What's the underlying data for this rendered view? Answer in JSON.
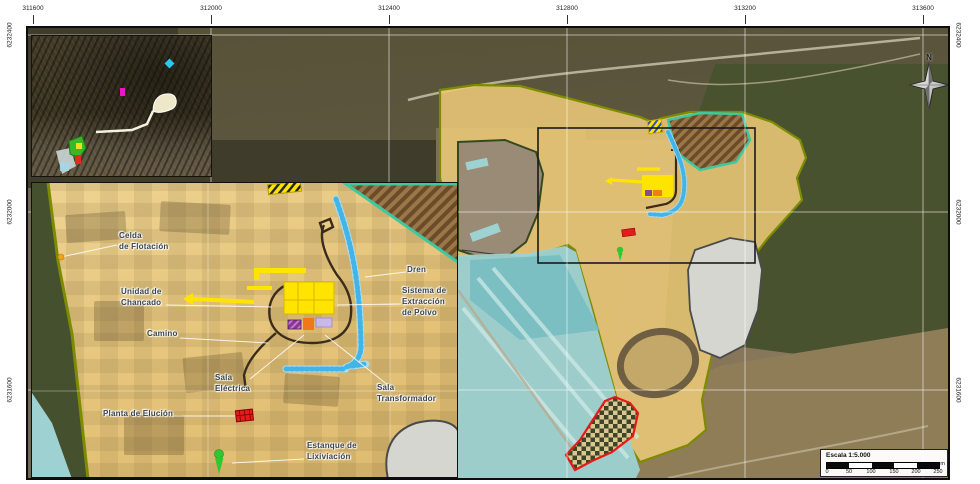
{
  "coordinates": {
    "top": [
      "311600",
      "312000",
      "312400",
      "312800",
      "313200",
      "313600"
    ],
    "left": [
      "6232400",
      "6232000",
      "6231600"
    ],
    "right": [
      "6232400",
      "6232000",
      "6231600"
    ]
  },
  "labels": {
    "celda": [
      "Celda",
      "de Flotación"
    ],
    "unidad": [
      "Unidad de",
      "Chancado"
    ],
    "camino": [
      "Camino"
    ],
    "sala_electrica": [
      "Sala",
      "Eléctrica"
    ],
    "planta": [
      "Planta de Elución"
    ],
    "estanque": [
      "Estanque de",
      "Lixiviación"
    ],
    "dren": [
      "Dren"
    ],
    "sistema": [
      "Sistema de",
      "Extracción",
      "de Polvo"
    ],
    "sala_transformador": [
      "Sala",
      "Transformador"
    ]
  },
  "north": {
    "label": "N"
  },
  "scalebar": {
    "title": "Escala 1:5.000",
    "ticks": [
      "0",
      "50",
      "100",
      "150",
      "200",
      "250"
    ],
    "unit": "m"
  },
  "colors": {
    "project_fill": "#eac878",
    "project_border": "#7d8b00",
    "facility_yellow": "#ffe400",
    "drain_blue": "#42b4e6",
    "tailings_cyan": "#9ed2d2",
    "hatch_brown": "#6d4a28",
    "hatch_teal": "#3ec8a0",
    "marker_red": "#e41c1c",
    "marker_green": "#2fc82f",
    "marker_orange": "#f2a21f",
    "pond_gray": "#d6d6d0",
    "restricted_red": "#e81818"
  }
}
